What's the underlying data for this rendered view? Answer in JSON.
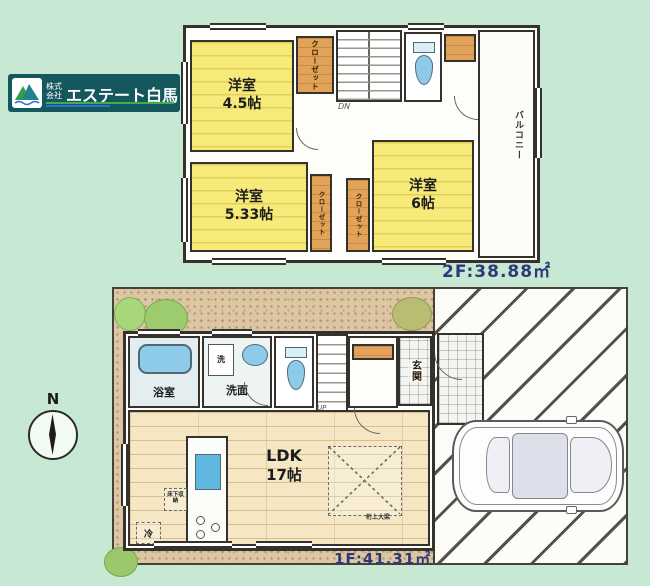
{
  "colors": {
    "bg_mint": "#c7e9d4",
    "wall": "#35322e",
    "room_yellow": "#f6eb7a",
    "closet_orange": "#e2a258",
    "water_blue": "#8ecbe9",
    "accent_navy": "#2c3a78",
    "logo_teal": "#14585e"
  },
  "logo": {
    "prefix": "株式会社",
    "name": "エステート白馬"
  },
  "compass": {
    "north": "N"
  },
  "floor2": {
    "area": "2F:38.88㎡",
    "room_a": {
      "name": "洋室",
      "size": "4.5帖"
    },
    "room_b": {
      "name": "洋室",
      "size": "5.33帖"
    },
    "room_c": {
      "name": "洋室",
      "size": "6帖"
    },
    "closet_top": "クローゼット",
    "closet_left": "クローゼット",
    "closet_right": "クローゼット",
    "balcony": "バルコニー",
    "stairs": "DN"
  },
  "floor1": {
    "area": "1F:41.31㎡",
    "ldk_name": "LDK",
    "ldk_size": "17帖",
    "bath": "浴室",
    "washroom": "洗面",
    "washer": "洗",
    "entrance": "玄関",
    "stairs": "UP",
    "fridge": "冷",
    "floor_storage": "床下収納",
    "beam_note": "桁上大梁"
  }
}
